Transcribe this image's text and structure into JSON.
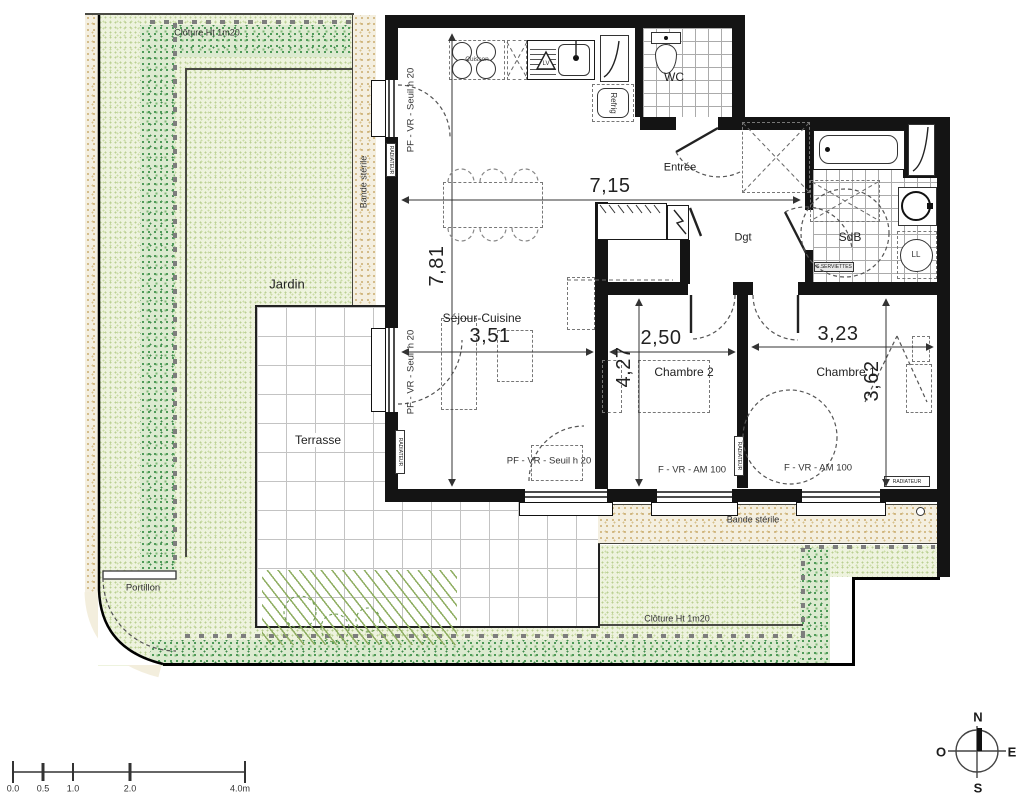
{
  "plan": {
    "rooms": {
      "jardin": "Jardin",
      "terrasse": "Terrasse",
      "sejour": "Séjour-Cuisine",
      "chambre2": "Chambre 2",
      "chambre1": "Chambre 1",
      "entree": "Entrée",
      "dgt": "Dgt",
      "sdb": "SdB",
      "wc": "WC"
    },
    "dims": {
      "total_w": "7,15",
      "total_h": "7,81",
      "sejour_w": "3,51",
      "ch2_w": "2,50",
      "ch2_h": "4,27",
      "ch1_w": "3,23",
      "ch1_h": "3,62"
    },
    "equip": {
      "cuisson": "Cuisson",
      "refrig": "Refrig",
      "lv": "LV",
      "ll": "LL",
      "radiateur": "RADIATEUR",
      "seche": "S.SERVIETTES"
    },
    "windows": {
      "pf_left_top": "PF - VR - Seuil h 20",
      "pf_left_bottom": "PF - VR - Seuil h 20",
      "pf_sejour": "PF - VR - Seuil h 20",
      "f_ch2": "F - VR - AM 100",
      "f_ch1": "F - VR - AM 100"
    },
    "site": {
      "cloture_top": "Clôture Ht 1m20",
      "cloture_bottom": "Clôture Ht 1m20",
      "bande_left": "Bande stérile",
      "bande_bottom": "Bande stérile",
      "portillon": "Portillon"
    },
    "scalebar": {
      "t0": "0.0",
      "t1": "0.5",
      "t2": "1.0",
      "t3": "2.0",
      "t4": "4.0m"
    },
    "compass": {
      "n": "N",
      "s": "S",
      "e": "E",
      "o": "O"
    },
    "colors": {
      "wall": "#141414",
      "garden": "#eef3de",
      "garden_dots": "#b9cf92",
      "hedge_dots": "#4e9a58",
      "sterile_band": "#f4efe0",
      "fence": "#7d7d7d"
    }
  }
}
